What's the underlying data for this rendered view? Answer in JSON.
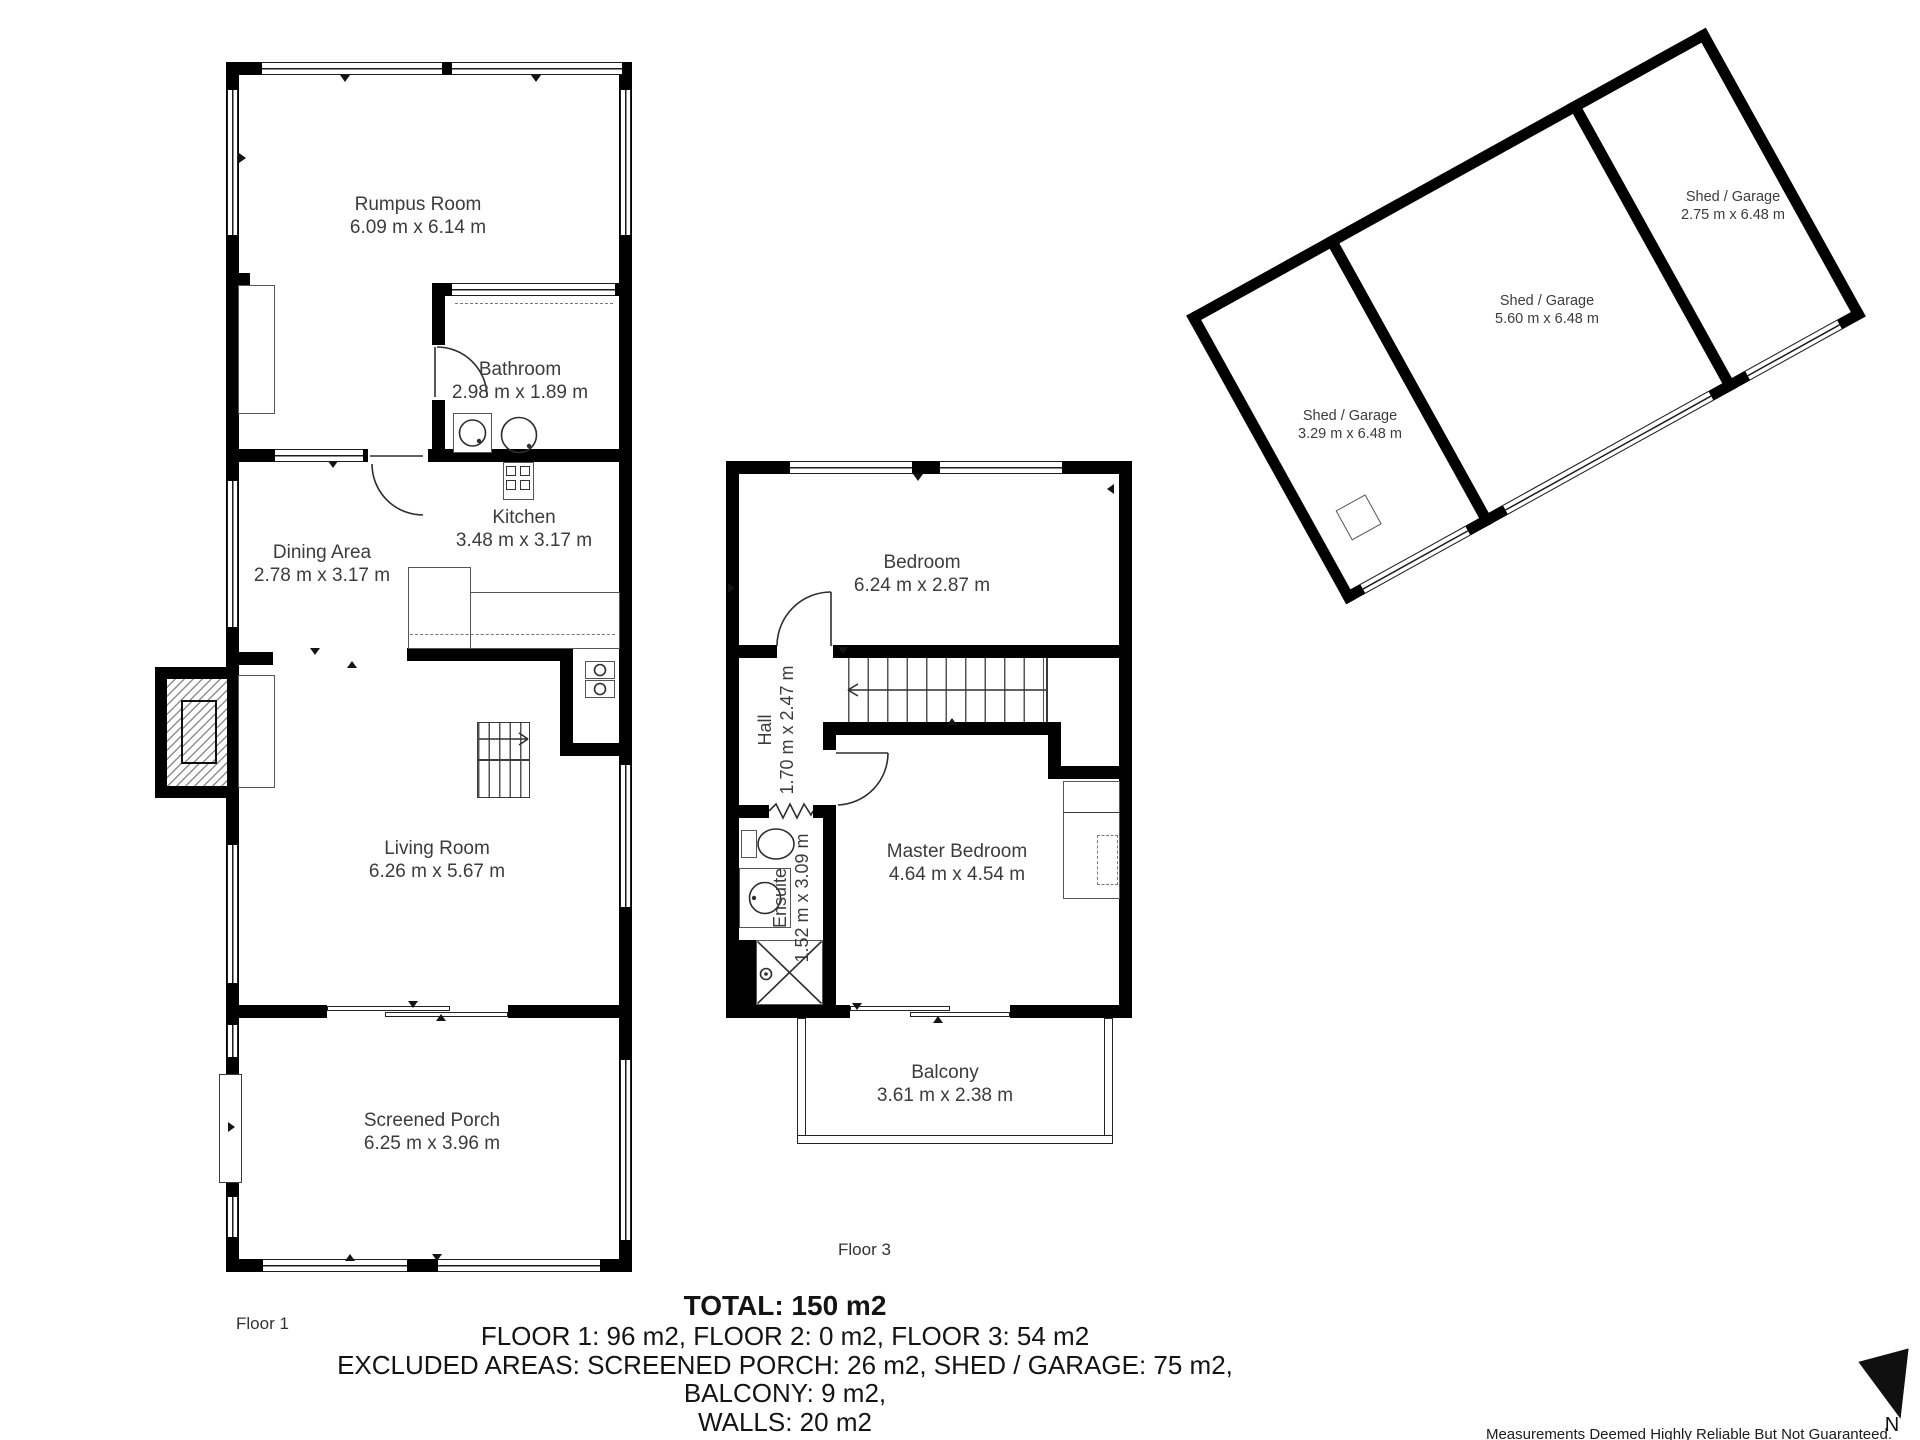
{
  "floor1": {
    "label": "Floor 1",
    "rooms": {
      "rumpus": {
        "name": "Rumpus Room",
        "dims": "6.09 m x 6.14 m"
      },
      "bathroom": {
        "name": "Bathroom",
        "dims": "2.98 m x 1.89 m"
      },
      "kitchen": {
        "name": "Kitchen",
        "dims": "3.48 m x 3.17 m"
      },
      "dining": {
        "name": "Dining Area",
        "dims": "2.78 m x 3.17 m"
      },
      "living": {
        "name": "Living Room",
        "dims": "6.26 m x 5.67 m"
      },
      "porch": {
        "name": "Screened Porch",
        "dims": "6.25 m x 3.96 m"
      }
    }
  },
  "floor3": {
    "label": "Floor 3",
    "rooms": {
      "bedroom": {
        "name": "Bedroom",
        "dims": "6.24 m x 2.87 m"
      },
      "hall": {
        "name": "Hall",
        "dims": "1.70 m x 2.47 m"
      },
      "ensuite": {
        "name": "Ensuite",
        "dims": "1.52 m x 3.09 m"
      },
      "master": {
        "name": "Master Bedroom",
        "dims": "4.64 m x 4.54 m"
      },
      "balcony": {
        "name": "Balcony",
        "dims": "3.61 m x 2.38 m"
      }
    }
  },
  "shed": {
    "sections": [
      {
        "name": "Shed / Garage",
        "dims": "3.29 m x 6.48 m"
      },
      {
        "name": "Shed / Garage",
        "dims": "5.60 m x 6.48 m"
      },
      {
        "name": "Shed / Garage",
        "dims": "2.75 m x 6.48 m"
      }
    ]
  },
  "summary": {
    "total": "TOTAL: 150 m2",
    "floors": "FLOOR 1: 96 m2, FLOOR 2: 0 m2, FLOOR 3: 54 m2",
    "excluded": "EXCLUDED AREAS: SCREENED PORCH: 26 m2, SHED / GARAGE: 75 m2, BALCONY: 9 m2,",
    "walls": "WALLS: 20 m2"
  },
  "compass": {
    "label": "N"
  },
  "disclaimer": "Measurements Deemed Highly Reliable But Not Guaranteed.",
  "colors": {
    "wall": "#000000",
    "line": "#2e2e2e",
    "text": "#3c3c3c"
  }
}
